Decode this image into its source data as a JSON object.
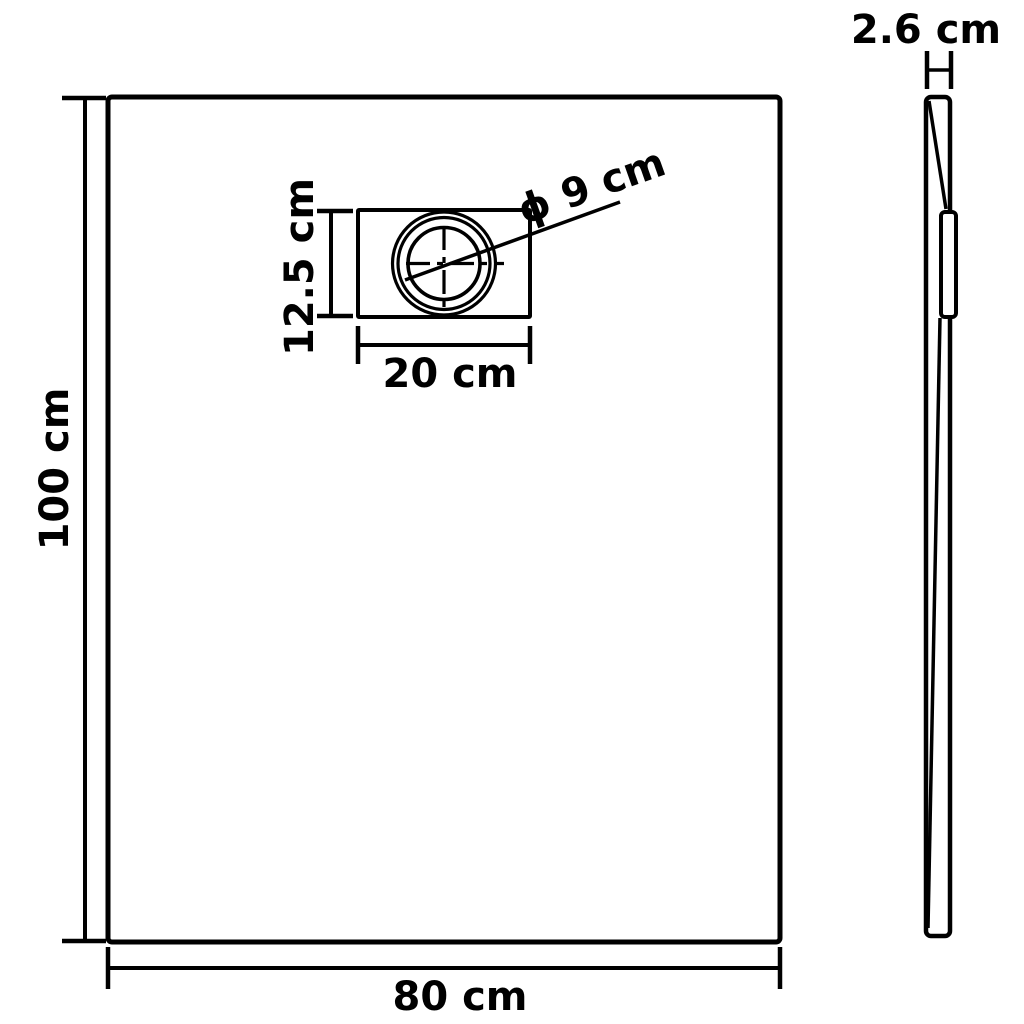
{
  "diagram": {
    "background_color": "#ffffff",
    "line_color": "#000000",
    "front_view": {
      "height_label": "100 cm",
      "width_label": "80 cm",
      "drain": {
        "height_label": "12.5 cm",
        "width_label": "20 cm",
        "diameter_label": "ϕ 9 cm"
      }
    },
    "side_view": {
      "thickness_label": "2.6 cm"
    }
  }
}
